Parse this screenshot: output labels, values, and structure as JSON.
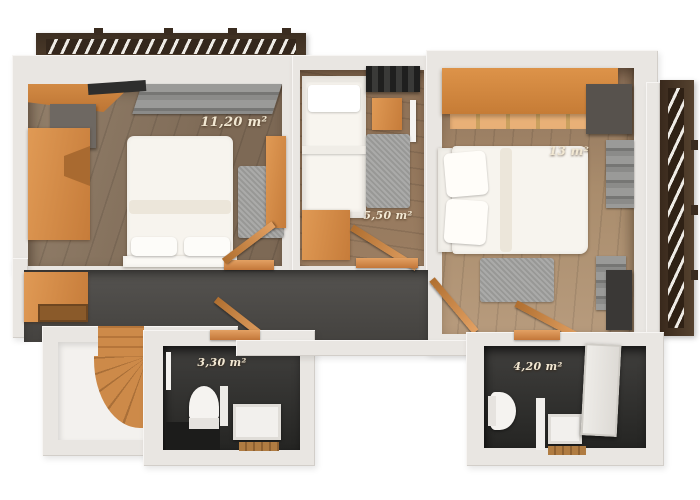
{
  "scene": {
    "type": "3D rendered apartment floor plan, top-down view",
    "background_color": "#ffffff"
  },
  "rooms": [
    {
      "id": "bedroom-left",
      "area_label": "11,20 m²"
    },
    {
      "id": "bedroom-right",
      "area_label": "13 m²"
    },
    {
      "id": "middle-room",
      "area_label": "5,50 m²"
    },
    {
      "id": "bathroom-left",
      "area_label": "3,30 m²"
    },
    {
      "id": "bathroom-right",
      "area_label": "4,20 m²"
    }
  ],
  "palette": {
    "wall": "#e9e6e2",
    "wood_floor_dark": "#7d6955",
    "wood_floor_light": "#b79b7d",
    "hallway_floor": "#4a4845",
    "bathroom_dark": "#2b2b29",
    "furniture_orange": "#d0883f",
    "pergola_brown": "#463627",
    "bed_white": "#f7f4ee",
    "rug_gray": "#a1a19f",
    "label_cream": "#f2e8d3"
  }
}
